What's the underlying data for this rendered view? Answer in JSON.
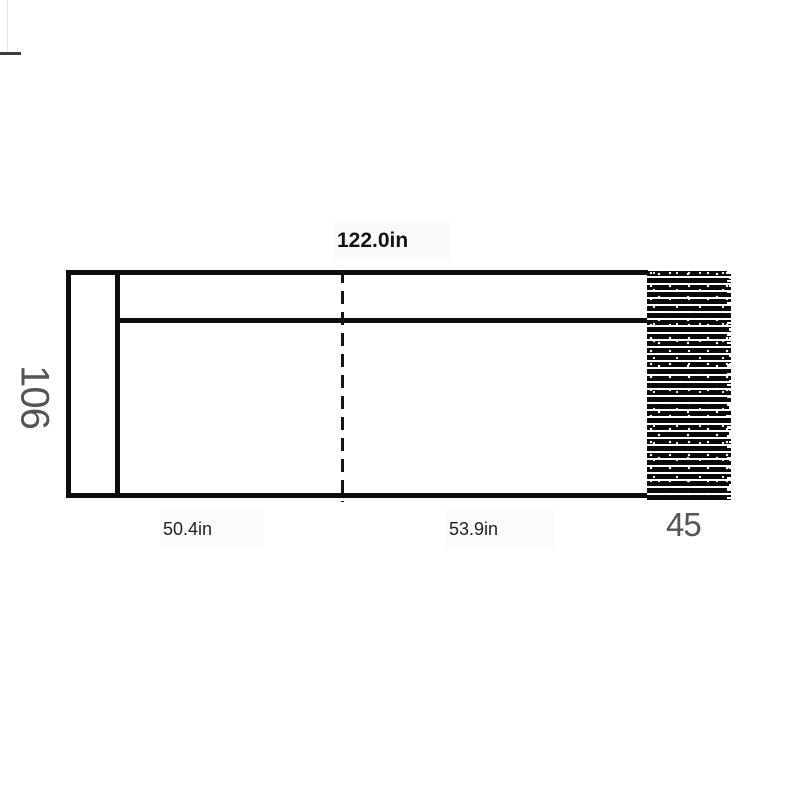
{
  "diagram": {
    "title_dimension": "122.0in",
    "height_dimension": "106",
    "left_section_dimension": "50.4in",
    "right_section_dimension": "53.9in",
    "hatch_dimension": "45",
    "colors": {
      "line": "#0d0d0d",
      "dimension_text": "#141414",
      "secondary_text": "#545454",
      "label_background": "#fafafa",
      "hatch_fill": "#0a0a0a",
      "background": "#ffffff"
    },
    "dashed_line": {
      "dash_px": 13,
      "gap_px": 8
    }
  }
}
